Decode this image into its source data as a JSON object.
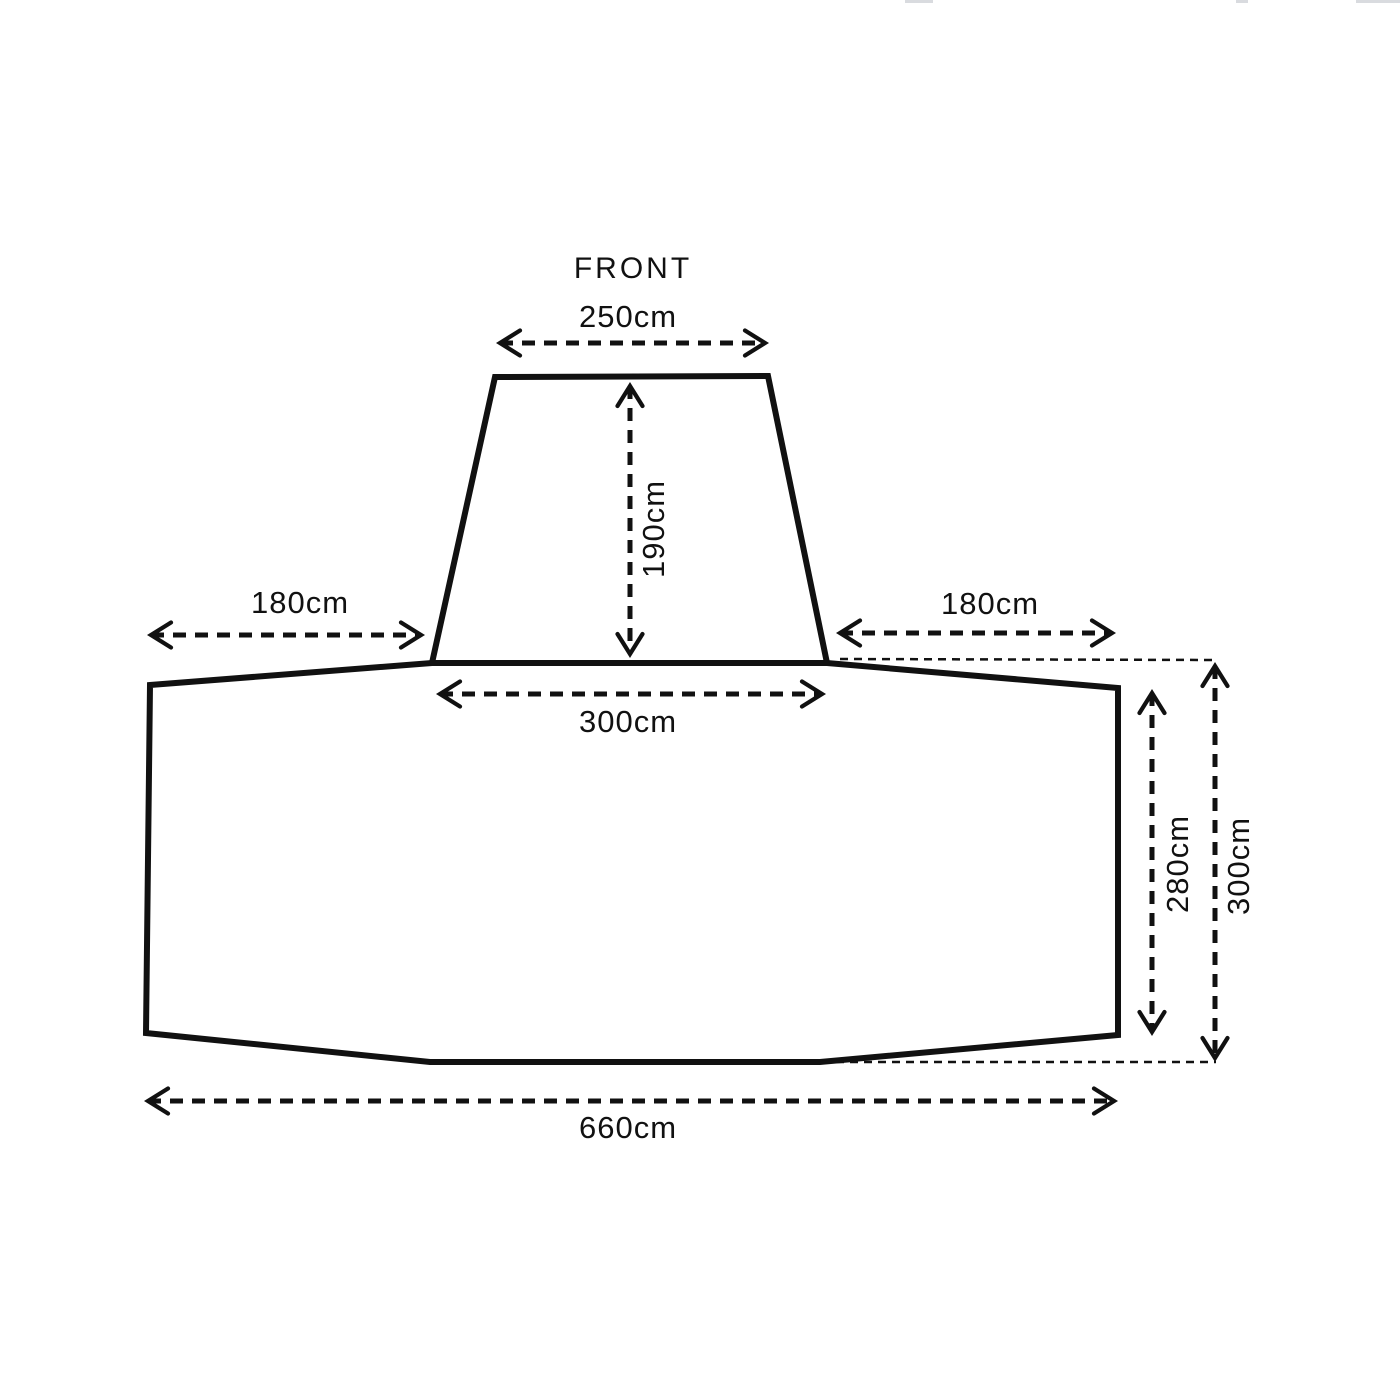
{
  "colors": {
    "ink": "#111111",
    "background": "#ffffff"
  },
  "diagram": {
    "title": "FRONT",
    "unit": "cm",
    "labels": {
      "front_width": "250cm",
      "front_depth": "190cm",
      "left_offset": "180cm",
      "right_offset": "180cm",
      "junction_width": "300cm",
      "inner_depth": "280cm",
      "outer_depth": "300cm",
      "overall_width": "660cm"
    }
  }
}
